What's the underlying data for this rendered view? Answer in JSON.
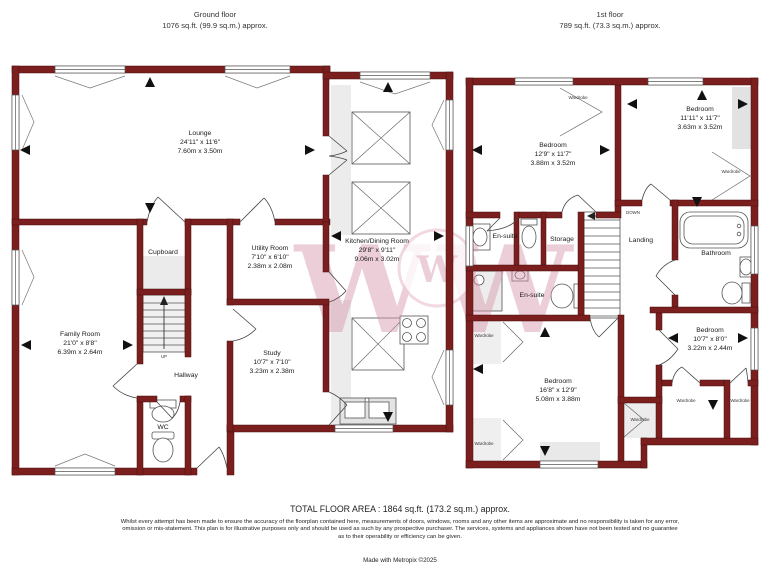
{
  "header": {
    "ground": {
      "title": "Ground floor",
      "area": "1076 sq.ft. (99.9 sq.m.) approx."
    },
    "first": {
      "title": "1st floor",
      "area": "789 sq.ft. (73.3 sq.m.) approx."
    }
  },
  "ground_floor": {
    "lounge": {
      "name": "Lounge",
      "imperial": "24'11\" x 11'6\"",
      "metric": "7.60m x 3.50m"
    },
    "kitchen": {
      "name": "Kitchen/Dining Room",
      "imperial": "29'8\" x 9'11\"",
      "metric": "9.06m x 3.02m"
    },
    "utility": {
      "name": "Utility Room",
      "imperial": "7'10\" x 6'10\"",
      "metric": "2.38m x 2.08m"
    },
    "cupboard": {
      "name": "Cupboard"
    },
    "family": {
      "name": "Family Room",
      "imperial": "21'0\" x 8'8\"",
      "metric": "6.39m x 2.64m"
    },
    "study": {
      "name": "Study",
      "imperial": "10'7\" x 7'10\"",
      "metric": "3.23m x 2.38m"
    },
    "hallway": {
      "name": "Hallway"
    },
    "wc": {
      "name": "WC"
    },
    "stairs": {
      "label": "UP"
    }
  },
  "first_floor": {
    "bedroom1": {
      "name": "Bedroom",
      "imperial": "12'9\" x 11'7\"",
      "metric": "3.88m x 3.52m"
    },
    "bedroom2": {
      "name": "Bedroom",
      "imperial": "11'11\" x 11'7\"",
      "metric": "3.63m x 3.52m"
    },
    "bedroom3": {
      "name": "Bedroom",
      "imperial": "10'7\" x 8'0\"",
      "metric": "3.22m x 2.44m"
    },
    "bedroom4": {
      "name": "Bedroom",
      "imperial": "16'8\" x 12'9\"",
      "metric": "5.08m x 3.88m"
    },
    "ensuite_top": {
      "name": "En-suite"
    },
    "ensuite_bottom": {
      "name": "En-suite"
    },
    "storage": {
      "name": "Storage"
    },
    "landing": {
      "name": "Landing"
    },
    "bathroom": {
      "name": "Bathroom"
    },
    "stairs": {
      "label": "DOWN"
    },
    "wardrobe": "Wardrobe"
  },
  "footer": {
    "total": "TOTAL FLOOR AREA : 1864 sq.ft. (173.2 sq.m.) approx.",
    "disclaimer": "Whilst every attempt has been made to ensure the accuracy of the floorplan contained here, measurements of doors, windows, rooms and any other items are approximate and no responsibility is taken for any error, omission or mis-statement. This plan is for illustrative purposes only and should be used as such by any prospective purchaser. The services, systems and appliances shown have not been tested and no guarantee as to their operability or efficiency can be given.",
    "credit": "Made with Metropix ©2025"
  },
  "watermark": {
    "letter": "W"
  },
  "colors": {
    "wall": "#7b1e1e",
    "watermark": "#d795aa"
  }
}
